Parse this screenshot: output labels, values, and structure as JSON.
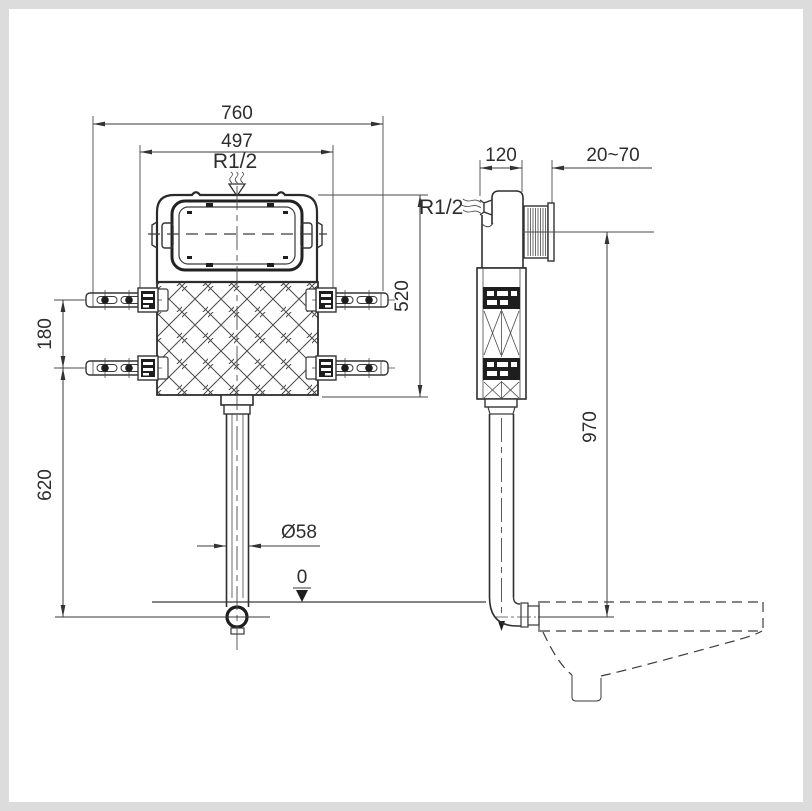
{
  "drawing": {
    "type": "technical installation drawing",
    "subject": "concealed toilet cistern, front and side views with wall-hung bowl",
    "colors": {
      "background": "#dcdcdc",
      "canvas": "#ffffff",
      "line": "#3a3a3a"
    }
  },
  "front_view": {
    "dims": {
      "overall_width": "760",
      "inner_width": "497",
      "water_inlet": "R1/2",
      "tank_height": "520",
      "rail_spacing": "180",
      "outlet_depth": "620",
      "outlet_pipe_diameter": "Ø58",
      "datum_level": "0"
    }
  },
  "side_view": {
    "dims": {
      "tank_depth": "120",
      "wall_thickness_range": "20~70",
      "water_inlet": "R1/2",
      "flush_height": "970"
    }
  }
}
